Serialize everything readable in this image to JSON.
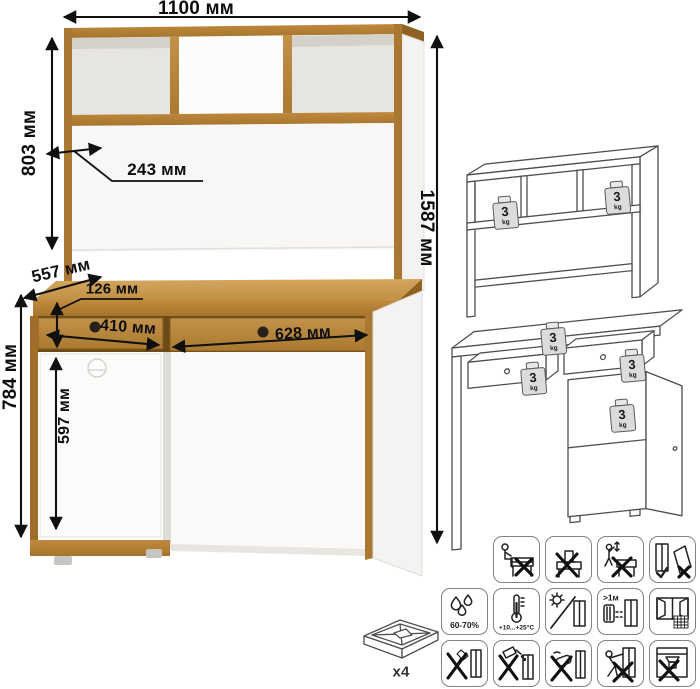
{
  "diagram": {
    "title_text": "",
    "dimensions": {
      "top_width": "1100 мм",
      "hutch_height": "803 мм",
      "total_height": "1587 мм",
      "shelf_side_depth": "243 мм",
      "desk_depth": "557 мм",
      "drawer_front_height": "126 мм",
      "left_drawer_width": "410 мм",
      "right_drawer_width": "628 мм",
      "desk_height": "784 мм",
      "door_height": "597 мм"
    },
    "load_badge": {
      "value": "3",
      "unit": "kg"
    },
    "feet_count_label": "x4",
    "care": {
      "humidity": "60-70%",
      "temperature": "+10...+25°C",
      "heater_distance": ">1м"
    },
    "colors": {
      "wood": "#b5813a",
      "wood_light": "#cb9c50",
      "wood_dark": "#96661f",
      "line_art": "#4f4f4f",
      "dimension_ink": "#101010"
    },
    "icon_meanings": [
      "no-sitting",
      "no-standing",
      "no-children-climbing",
      "transport-upright-only",
      "humidity-range",
      "temperature-range",
      "avoid-direct-sunlight",
      "keep-1m-from-heaters",
      "ventilated-room",
      "no-sharp-tools",
      "no-spilling-liquids",
      "no-abrasive-cleaning",
      "no-dragging",
      "no-press-loads"
    ]
  }
}
